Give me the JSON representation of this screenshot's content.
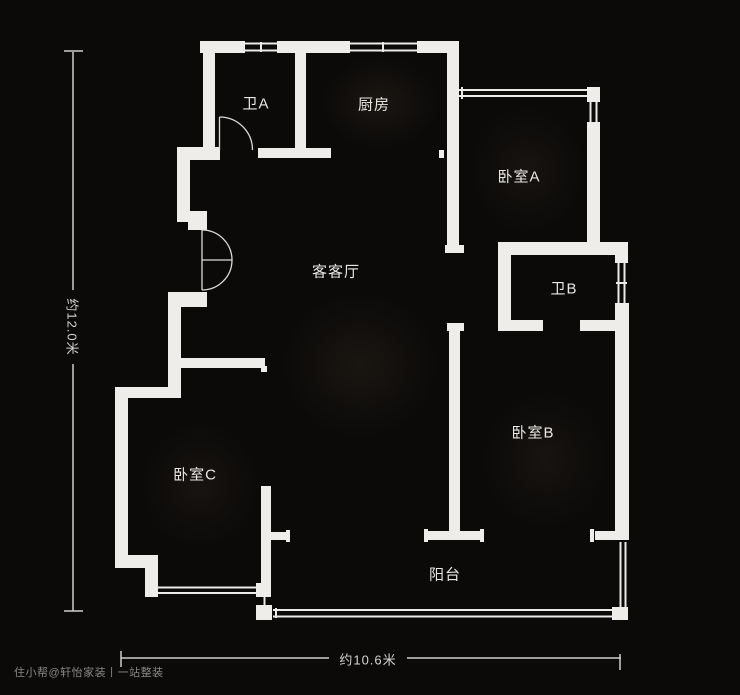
{
  "floorplan": {
    "rooms": [
      {
        "id": "bath-a",
        "label": "卫A"
      },
      {
        "id": "kitchen",
        "label": "厨房"
      },
      {
        "id": "bedroom-a",
        "label": "卧室A"
      },
      {
        "id": "living",
        "label": "客客厅"
      },
      {
        "id": "bath-b",
        "label": "卫B"
      },
      {
        "id": "bedroom-b",
        "label": "卧室B"
      },
      {
        "id": "bedroom-c",
        "label": "卧室C"
      },
      {
        "id": "balcony",
        "label": "阳台"
      }
    ],
    "dimensions": {
      "height_label": "约12.0米",
      "width_label": "约10.6米"
    },
    "watermark": "住小帮@轩怡家装丨一站整装",
    "colors": {
      "background": "#0b0a09",
      "wall": "#efede9",
      "window_line": "#eceae7",
      "door_line": "#dddbd8",
      "dimension_line": "#cfcdc9",
      "label_text": "#e9e7e4",
      "watermark_text": "#8a8886"
    }
  }
}
